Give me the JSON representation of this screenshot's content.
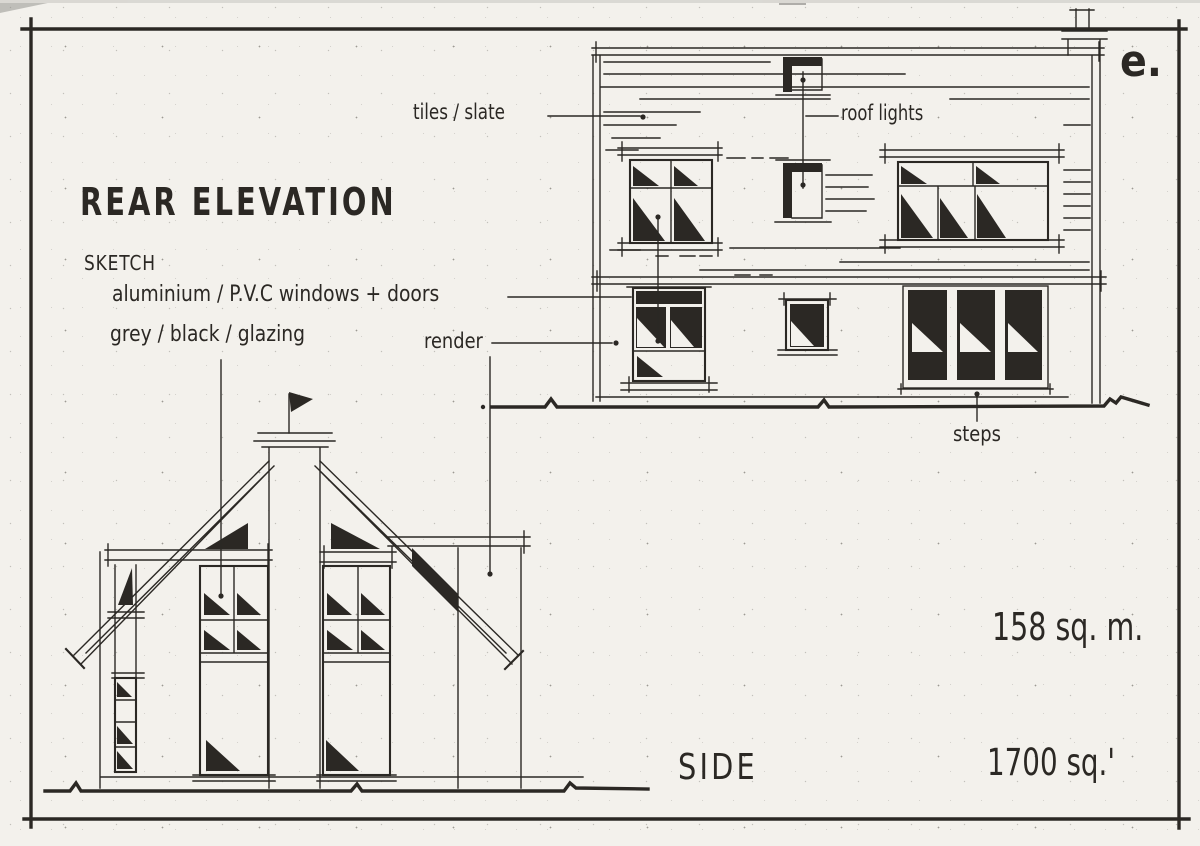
{
  "sheet": {
    "letter": "e.",
    "paper_color": "#f3f1ec",
    "ink_color": "#2b2824"
  },
  "title_block": {
    "title": "REAR ELEVATION",
    "subtitle": "SKETCH",
    "notes": [
      "aluminium / P.V.C windows + doors",
      "grey / black / glazing"
    ]
  },
  "annotations": {
    "tiles_slate": "tiles / slate",
    "roof_lights": "roof lights",
    "render": "render",
    "steps": "steps"
  },
  "side_view_label": "SIDE",
  "areas": {
    "metric": "158 sq. m.",
    "imperial": "1700 sq.'"
  }
}
